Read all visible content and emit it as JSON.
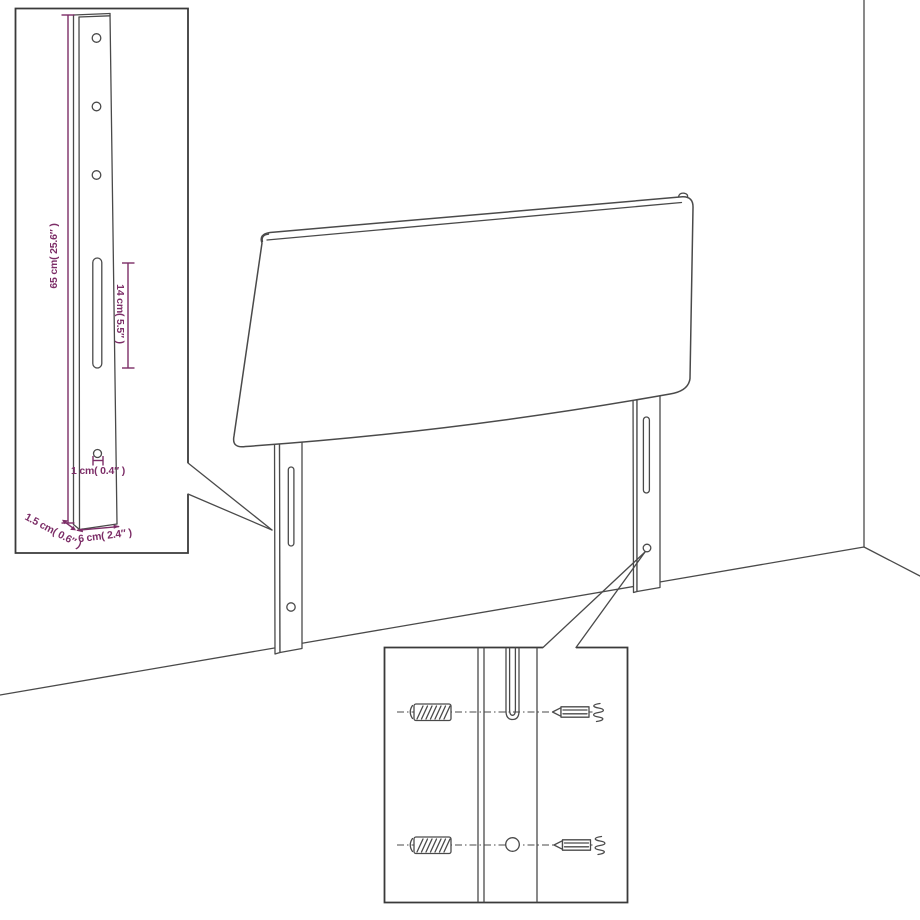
{
  "diagram": {
    "subject": "headboard-with-mounting-legs-in-room-corner",
    "colors": {
      "line": "#4a4a4a",
      "box_border": "#3a3a3a",
      "dimension_accent": "#7c2d67",
      "background": "#ffffff"
    },
    "leg_detail_inset": {
      "labels": {
        "leg_height": "65 cm( 25.6″ )",
        "slot_length": "14 cm( 5.5″ )",
        "hole_diameter": "1 cm( 0.4″ )",
        "leg_depth": "1.5 cm( 0.6″ )",
        "leg_width": "6 cm( 2.4″ )"
      }
    },
    "mounting_detail_inset": {
      "icons": [
        "wood-screw-icon",
        "machine-bolt-icon",
        "spring-anchor-icon",
        "mounting-slot",
        "mounting-hole"
      ]
    }
  }
}
